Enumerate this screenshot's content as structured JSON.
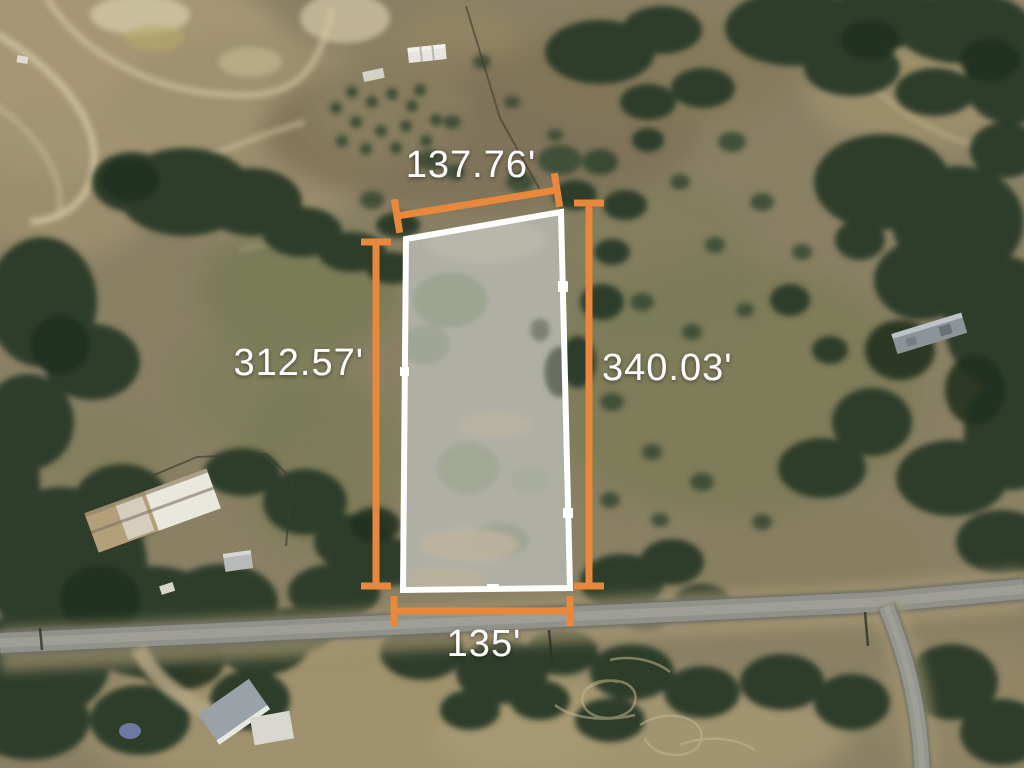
{
  "map_overlay": {
    "dimensions": {
      "top": "137.76'",
      "left": "312.57'",
      "right": "340.03'",
      "bottom": "135'"
    },
    "colors": {
      "dimension_line": "#e8883c",
      "parcel_outline": "#ffffff",
      "label_text": "#ffffff"
    }
  }
}
